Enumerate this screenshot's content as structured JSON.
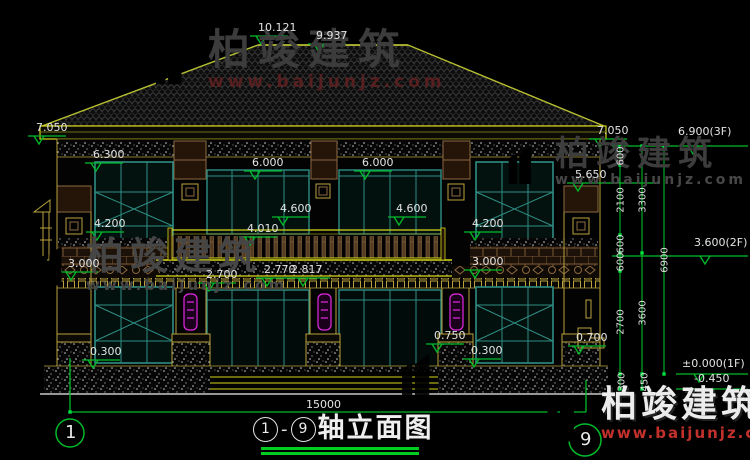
{
  "watermark": {
    "brand": "柏竣建筑",
    "site": "www.baijunjz.com"
  },
  "title": {
    "axis_start": "1",
    "axis_end": "9",
    "separator": "-",
    "text": "轴立面图"
  },
  "axis": {
    "left_bubble": "1",
    "right_bubble": "9"
  },
  "dims": {
    "d10121": "10.121",
    "d9937": "9.937",
    "d7050L": "7.050",
    "d7050R": "7.050",
    "d6300": "6.300",
    "d5650": "5.650",
    "d6000a": "6.000",
    "d6000b": "6.000",
    "d4600a": "4.600",
    "d4600b": "4.600",
    "d4010": "4.010",
    "d4200L": "4.200",
    "d4200R": "4.200",
    "d3000L": "3.000",
    "d3000R": "3.000",
    "d2700": "2.700",
    "d2770": "2.770",
    "d2817": "2.817",
    "d0300L": "0.300",
    "d0300R": "0.300",
    "d0750": "0.750",
    "d0700": "0.700",
    "f3": "6.900(3F)",
    "f2": "3.600(2F)",
    "f1": "±0.000(1F)",
    "fneg": "-0.450",
    "v600a": "600",
    "v2100": "2100",
    "v3300": "3300",
    "v600b": "600",
    "v600c": "600",
    "v6900": "6900",
    "v2700": "2700",
    "v3600": "3600",
    "v300": "300",
    "v450": "450",
    "total": "15000"
  },
  "colors": {
    "dimension_green": "#00bb2a",
    "trim_yellow": "#d6d61a",
    "frame_teal": "#2f8e84",
    "lamp_magenta": "#e428e4",
    "logo_blue": "#1f55b0",
    "logo_orange": "#ee7d1d",
    "watermark_gray": "#3e3e3e",
    "site_red": "#c2312b"
  }
}
